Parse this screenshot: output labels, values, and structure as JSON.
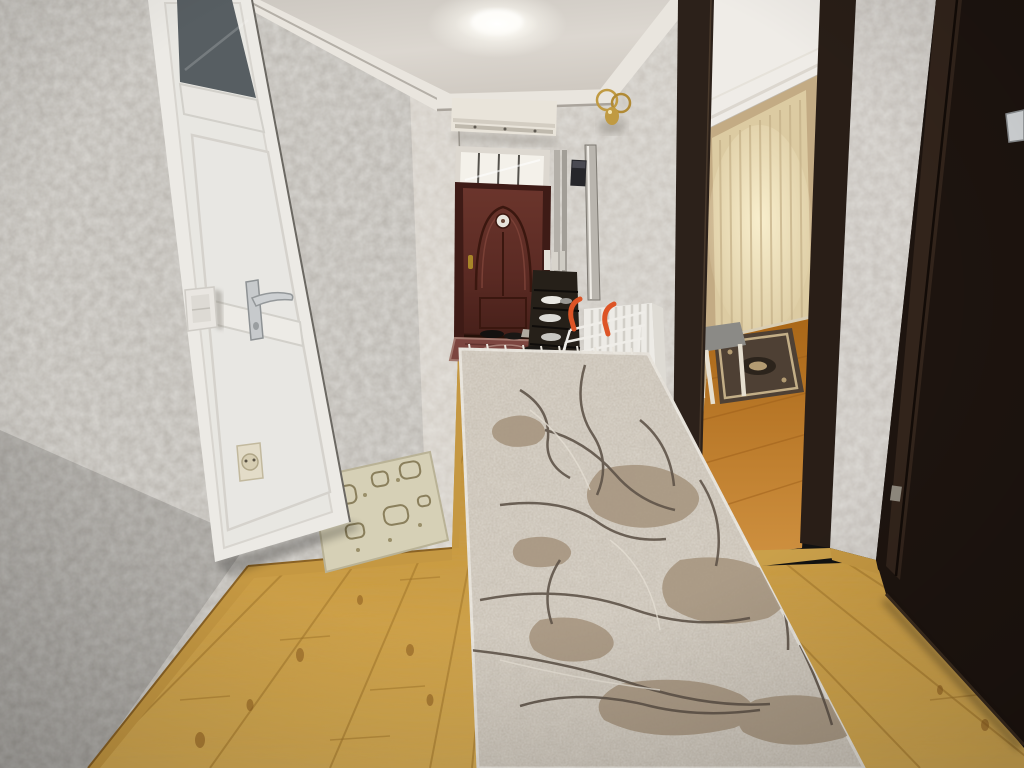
{
  "meta": {
    "type": "photograph",
    "subject": "Residential hallway interior",
    "style": "real-estate listing photo, camera slightly tilted",
    "width_px": 1024,
    "height_px": 768
  },
  "scene": {
    "description": "A long apartment hallway with textured venetian-plaster gray walls. Left: white PVC door with dark frosted top glass, chrome lever handle, light switch and socket on the wall, a beige patterned doormat by its base. Center: hallway recedes to a burgundy ornate entrance door with bright transom window, white air-conditioner unit above under crown molding, gold wall sconce, wall pipes and intercom, a black shoe rack with white shoes, a red doormat and dark shoes at the entrance, a white aluminum radiator with an orange-handled drying rack leaning on it. Floor: golden pine planks with a gray-taupe marbled runner carpet. Right: two dark-brown doorways; the near one opens into a room with glowing cream curtains, an oriental rug, orange wood floor and a chair; the far right is a dark open door.",
    "elements": [
      "ceiling",
      "ceiling-light",
      "crown-molding",
      "left-wall",
      "far-wall",
      "white-door",
      "door-handle",
      "light-switch",
      "power-socket",
      "entrance-door",
      "transom-window",
      "ac-unit",
      "wall-sconce",
      "pipes",
      "intercom",
      "shoe-rack",
      "shoes",
      "radiator",
      "drying-rack",
      "red-doormat",
      "beige-doormat",
      "wood-floor",
      "runner-carpet",
      "room-doorway",
      "curtains",
      "room-rug",
      "chair",
      "gray-wall-strip",
      "dark-open-door"
    ]
  },
  "lighting": {
    "source": "ceiling flush-mount light",
    "tone": "warm neutral, bright window glow in right room"
  },
  "palette": {
    "ceiling": "#d6d1ca",
    "crown": "#e9e5de",
    "wall_left": "#b9b5af",
    "wall_far": "#c9c4bd",
    "wall_strip": "#c5c0ba",
    "pillar": "#d2ccc4",
    "white_door": "#eceae5",
    "white_door_panel": "#e8e7e2",
    "door_glass": "#575e62",
    "handle_chrome": "#c7cacc",
    "switch": "#e9e6e1",
    "socket": "#e3dcc8",
    "entrance_frame": "#3e1b16",
    "entrance_door": "#5e2d26",
    "medallion": "#e8e4dc",
    "transom_frame": "#ddd8d0",
    "transom_glass": "#f4f1ea",
    "ac_unit": "#e9e4da",
    "sconce_gold": "#c09a42",
    "pipe": "#b3afa8",
    "intercom": "#26262a",
    "shoe_rack": "#262019",
    "shoe_white": "#e9e7e2",
    "radiator": "#edebe6",
    "rack_orange": "#dd5426",
    "bag_black": "#1b1815",
    "mat_red": "#7c453f",
    "mat_beige": "#d6d0b6",
    "mat_beige_pattern": "#8a7f5c",
    "wood_near": "#d4a94f",
    "wood_far": "#bd8a33",
    "baseboard": "#c59842",
    "plank_line": "#a0752b",
    "carpet_base": "#cbc3b6",
    "carpet_taupe": "#a5937d",
    "carpet_dark": "#5f5449",
    "carpet_fringe": "#eae6de",
    "jamb_dark": "#2c211a",
    "dark_door": "#1d140f",
    "dark_door_frame": "#32241b",
    "room_ceiling": "#efece7",
    "room_wall": "#c3ab84",
    "curtain": "#dccba2",
    "curtain_glow": "#f6ecca",
    "room_rug": "#4e4034",
    "rug_accent": "#c3ae87",
    "chair_leg": "#e6dfd0",
    "chair_seat": "#8b8a86",
    "room_floor": "#c07a28"
  }
}
